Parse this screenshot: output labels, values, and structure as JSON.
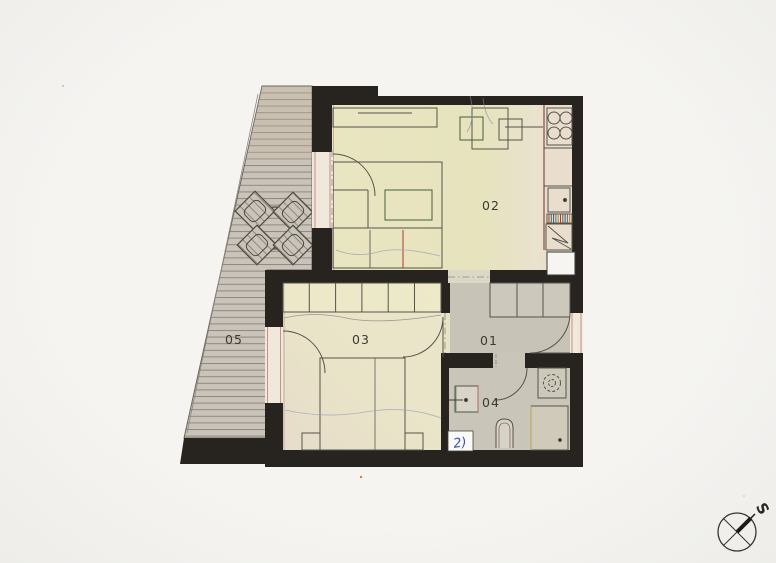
{
  "plan": {
    "rooms": [
      {
        "label": "01"
      },
      {
        "label": "02"
      },
      {
        "label": "03"
      },
      {
        "label": "04"
      },
      {
        "label": "05"
      }
    ],
    "compass": {
      "label": "S"
    },
    "notes": {
      "handwritten": "2)"
    },
    "palette": {
      "paper": "#f4f3f0",
      "wall": "#272420",
      "floor_living": "#e7e4bf",
      "floor_kitchen": "#e9ddcd",
      "floor_bedroom": "#e9e3c6",
      "floor_hall": "#c7c3b6",
      "terrace_deck": "#cac3b9",
      "accent_red": "#a93c31",
      "accent_green": "#46603f",
      "pencil_blue": "#3b55a8"
    }
  }
}
